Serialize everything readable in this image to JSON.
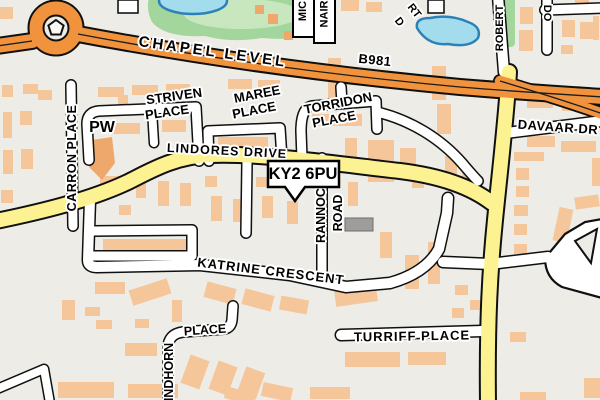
{
  "labels": {
    "postcode": "KY2 6PU",
    "pw": "PW",
    "chapel_level": "CHAPEL LEVEL",
    "b981": "B981",
    "lindores_drive": "LINDORES DRIVE",
    "carron_place": "CARRON PLACE",
    "striven_line1": "STRIVEN",
    "striven_line2": "PLACE",
    "maree_line1": "MAREE",
    "maree_line2": "PLACE",
    "torridon_line1": "TORRIDON",
    "torridon_line2": "PLACE",
    "davaar_drive": "DAVAAR DR",
    "rannoch_line1": "RANNOCH",
    "rannoch_line2": "ROAD",
    "katrine_crescent": "KATRINE CRESCENT",
    "turriff_place": "TURRIFF PLACE",
    "findhorn_vertical": "INDHORN",
    "findhorn_horizontal": "PLACE",
    "robert": "ROBERT",
    "mic": "MIC",
    "nair": "NAIR",
    "do": "DO",
    "cut_rt": "RT",
    "cut_d": "D"
  },
  "colors": {
    "background": "#edece6",
    "building": "#f4c69a",
    "building_accent": "#efa86b",
    "primary_road": "#f0933c",
    "secondary_road": "#fdf292",
    "road_casing": "#101010",
    "green_area": "#a3d69c",
    "green_light": "#c9e7bf",
    "water_fill": "#a3dcec",
    "water_stroke": "#2c82b8",
    "gray_building": "#9d9d9d",
    "label_text": "#000000"
  }
}
